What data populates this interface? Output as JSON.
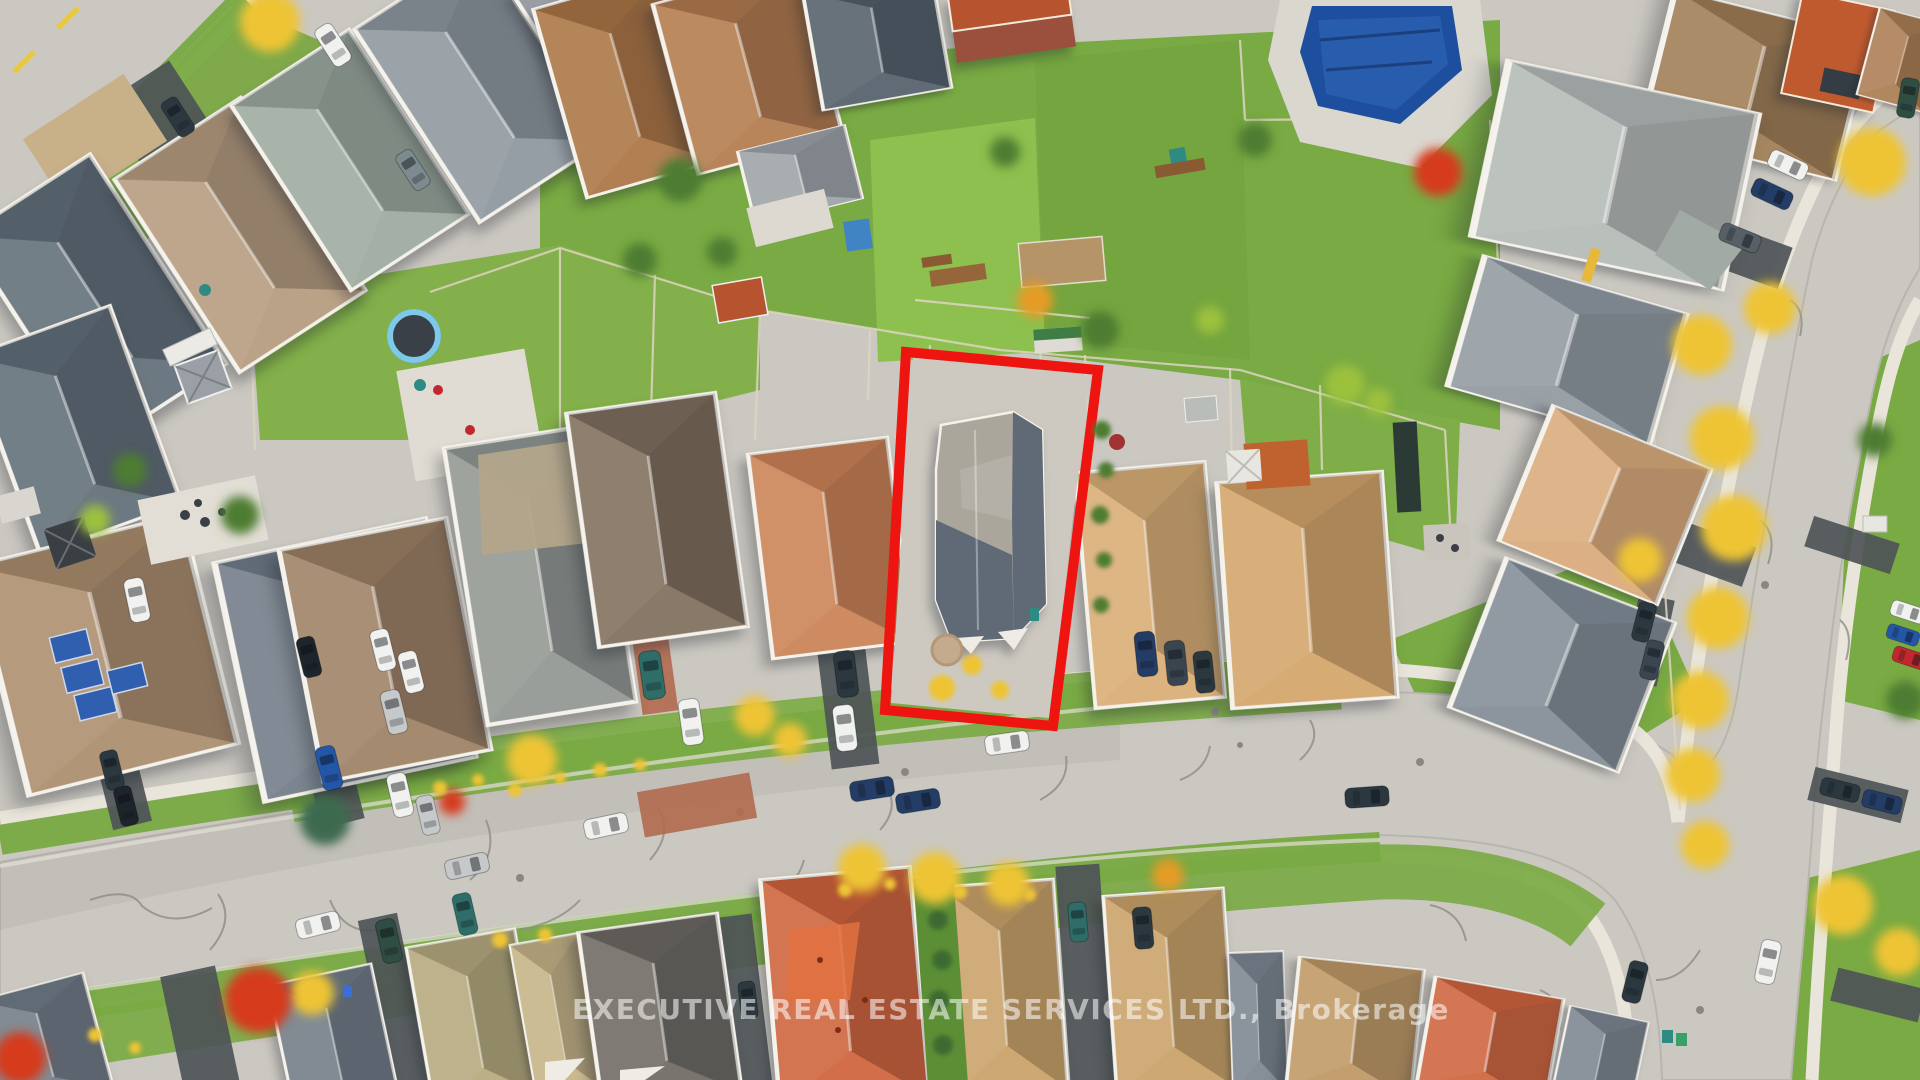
{
  "watermark": {
    "text": "EXECUTIVE REAL ESTATE SERVICES LTD., Brokerage"
  },
  "palette": {
    "road": "#cbc8c1",
    "sidewalk": "#e9e5da",
    "asphalt": "#4e5357",
    "grass": "#79aa43",
    "grassBright": "#8dc04f",
    "grassDark": "#5c8f35",
    "outlineRed": "#ee1511",
    "poolBlue": "#1e4f9e",
    "poolDeck": "#dad7cf",
    "autumnYellow": "#eec434",
    "autumnOrange": "#e59b28",
    "autumnRed": "#d63a1f",
    "treeGreen": "#4e7d33",
    "limeGreen": "#9cc13e",
    "roofSlate": "#5d6a74",
    "roofGray": "#8e979e",
    "roofLightGray": "#b2b8b4",
    "roofTan": "#d8ab70",
    "roofKhaki": "#c2a377",
    "roofBrown": "#9a7d5f",
    "roofDarkBrown": "#7c6a57",
    "roofRust": "#a9713f",
    "roofOrange": "#cd5f36",
    "roofSalmon": "#c97e50",
    "roofTaupe": "#b3a58b",
    "roofCharcoal": "#6a665e",
    "subjectRoofLight": "#aaa69c",
    "subjectRoofDark": "#5f6a76",
    "brick": "#9b4f3d",
    "terracotta": "#b5542f",
    "solarPanel": "#2f5fae",
    "carWhite": "#f1f1ef",
    "carSilver": "#c6c9c9",
    "carDark": "#2c3840",
    "carBlue": "#2456a8",
    "carTeal": "#2e6d68",
    "carRed": "#c1272d",
    "watermark": "rgba(255,255,255,0.55)"
  }
}
